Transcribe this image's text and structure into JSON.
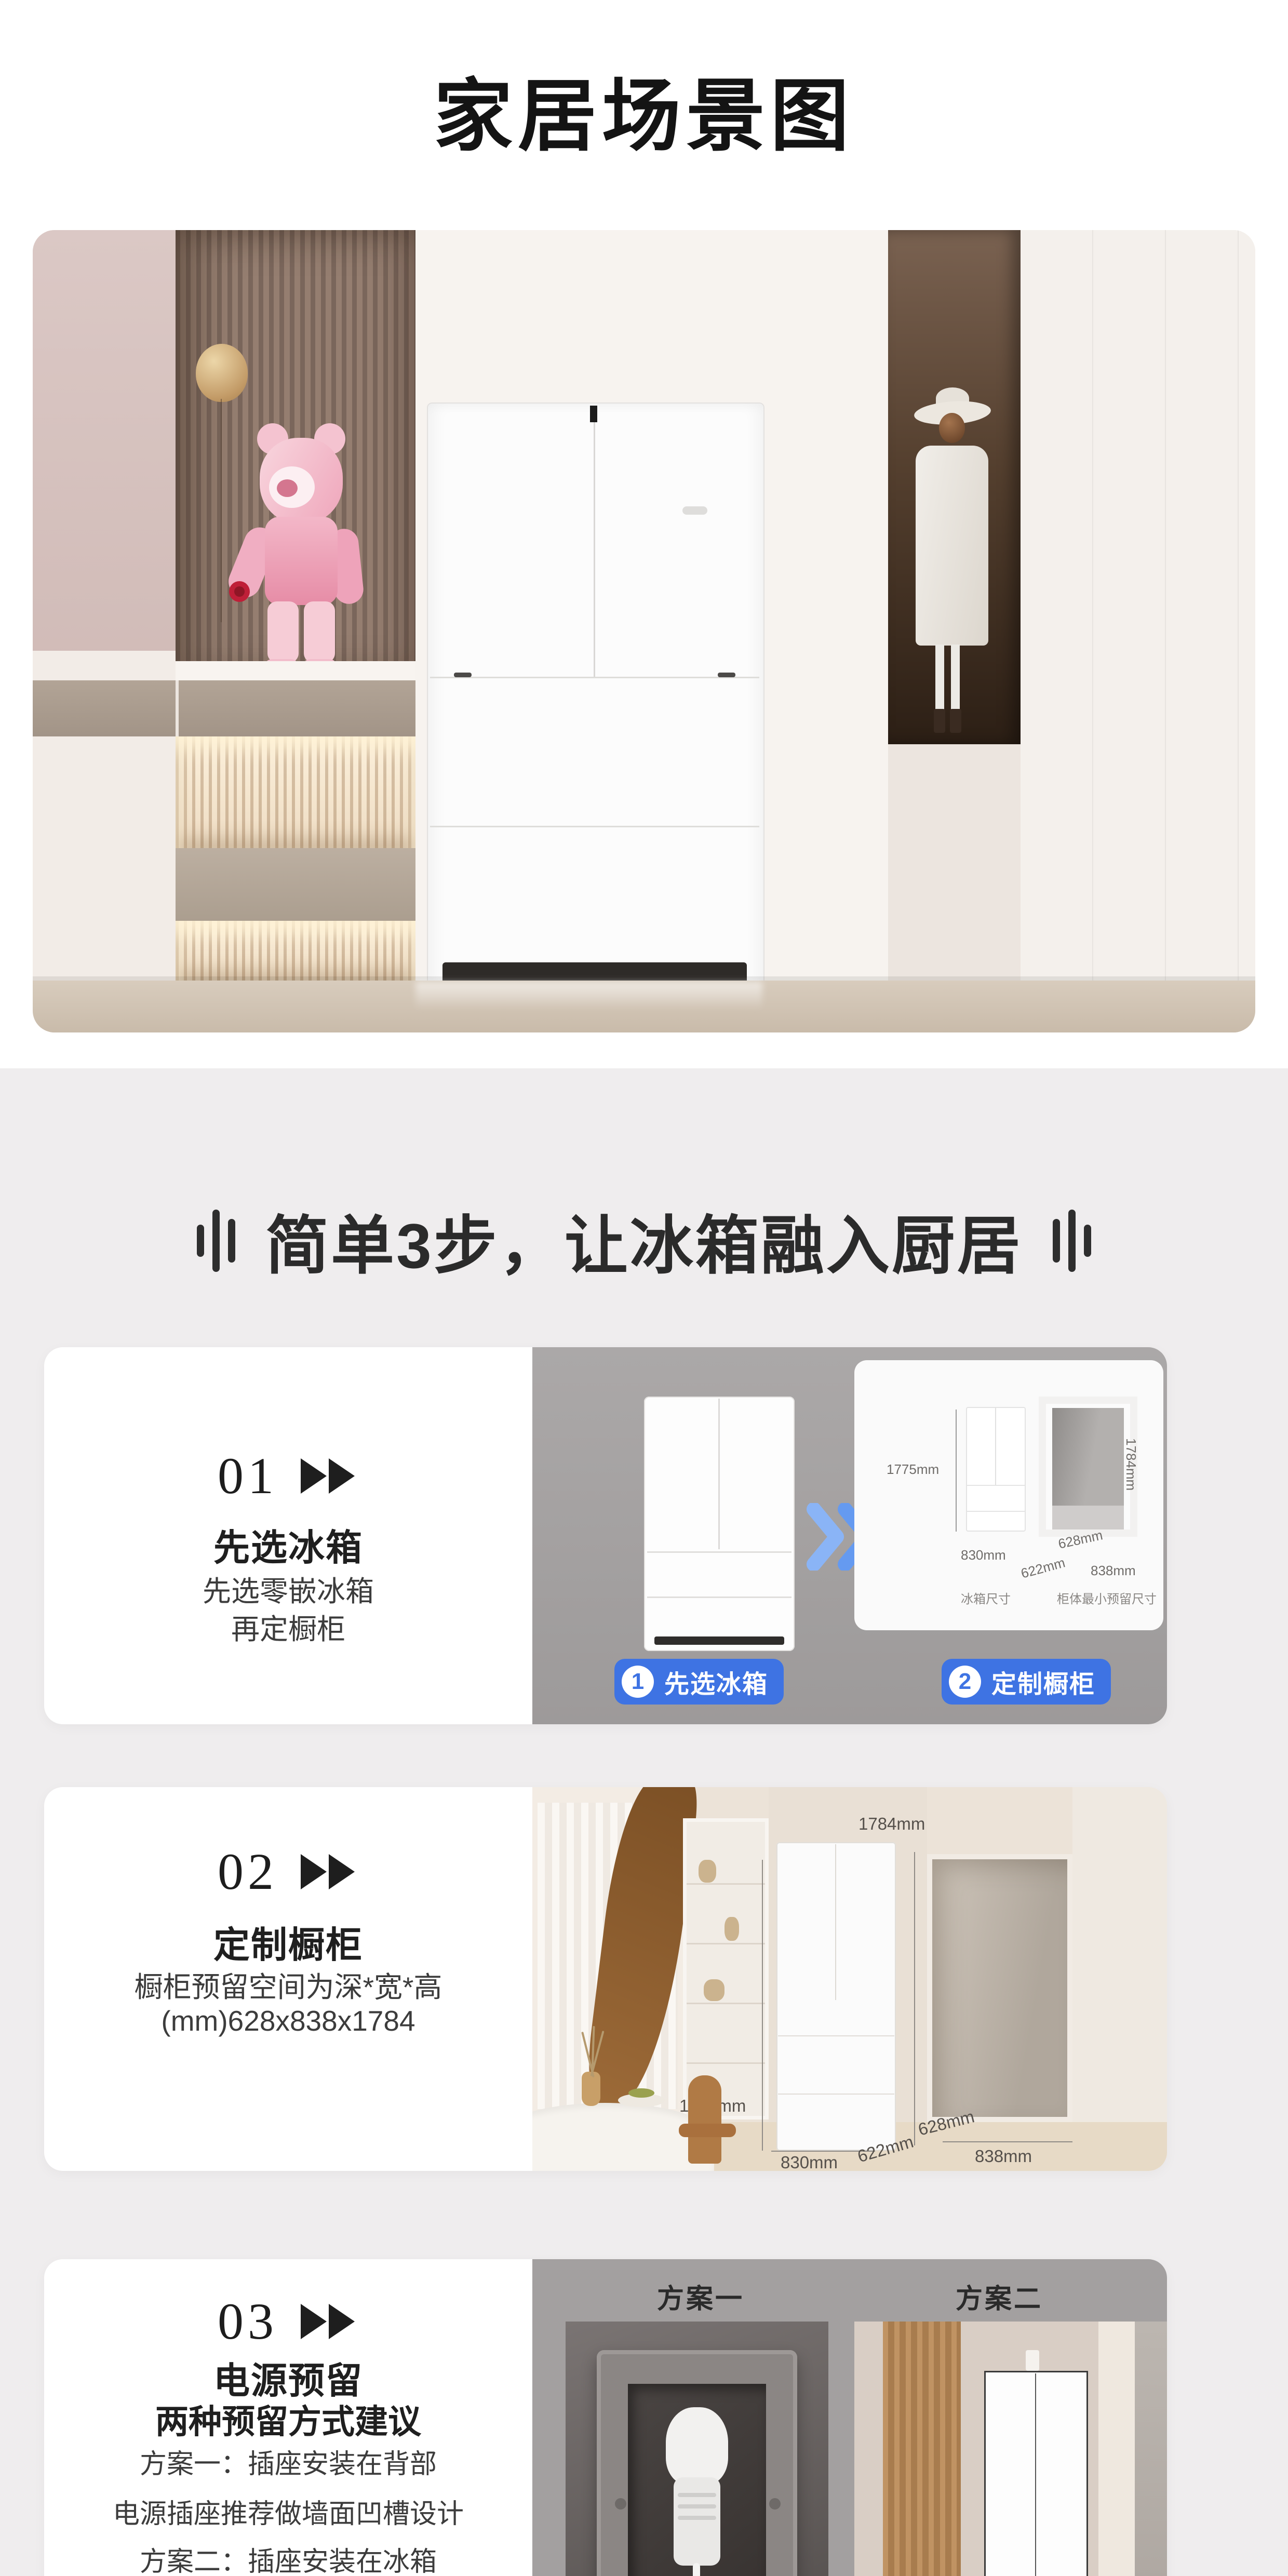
{
  "page": {
    "title": "家居场景图"
  },
  "section": {
    "title": "简单3步，让冰箱融入厨居"
  },
  "steps": [
    {
      "num": "01",
      "heading": "先选冰箱",
      "line1": "先选零嵌冰箱",
      "line2": "再定橱柜",
      "badge1": {
        "num": "1",
        "label": "先选冰箱"
      },
      "badge2": {
        "num": "2",
        "label": "定制橱柜"
      },
      "dims": {
        "fridge_height": "1775mm",
        "cabinet_height": "1784mm",
        "fridge_width": "830mm",
        "fridge_depth": "622mm",
        "cabinet_depth": "628mm",
        "cabinet_width": "838mm",
        "caption_left": "冰箱尺寸",
        "caption_right": "柜体最小预留尺寸"
      }
    },
    {
      "num": "02",
      "heading": "定制橱柜",
      "line1": "橱柜预留空间为深*宽*高",
      "line2": "(mm)628x838x1784",
      "dims": {
        "top": "1784mm",
        "left": "1775mm",
        "depth": "628mm",
        "width": "838mm",
        "fridge_width": "830mm",
        "fridge_depth": "622mm"
      }
    },
    {
      "num": "03",
      "heading": "电源预留",
      "subheading": "两种预留方式建议",
      "line1": "方案一：插座安装在背部",
      "line2": "电源插座推荐做墙面凹槽设计",
      "line3": "方案二：插座安装在冰箱",
      "plan1_label": "方案一",
      "plan2_label": "方案二"
    }
  ],
  "colors": {
    "accent_blue": "#3e73e3",
    "section_bg": "#efedee",
    "panel_gray": "#a7a4a4",
    "title_ink": "#141414"
  }
}
